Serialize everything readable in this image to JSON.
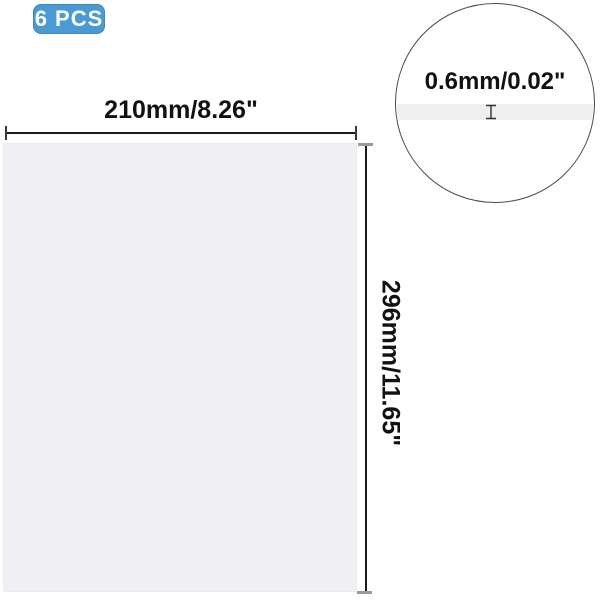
{
  "badge": {
    "label": "6 PCS",
    "bg_color": "#4A9BD3",
    "border_color": "#3C88BE",
    "text_color": "#FFFFFF"
  },
  "product": {
    "type": "blank sheet",
    "fill_color": "#F0F0F4"
  },
  "dimensions": {
    "width_label": "210mm/8.26\"",
    "height_label": "296mm/11.65\"",
    "thickness_label": "0.6mm/0.02\""
  },
  "detail_view": {
    "shape": "magnifier-circle",
    "edge_band_color": "#F0F0F2",
    "outline_color": "#4A4A4A"
  },
  "icons": {
    "thickness_marker": "i-beam-icon"
  },
  "colors": {
    "dimension_line": "#1B1B1B",
    "dimension_tick": "#9A9A9A",
    "label_text": "#111111",
    "background": "#FFFFFF"
  }
}
